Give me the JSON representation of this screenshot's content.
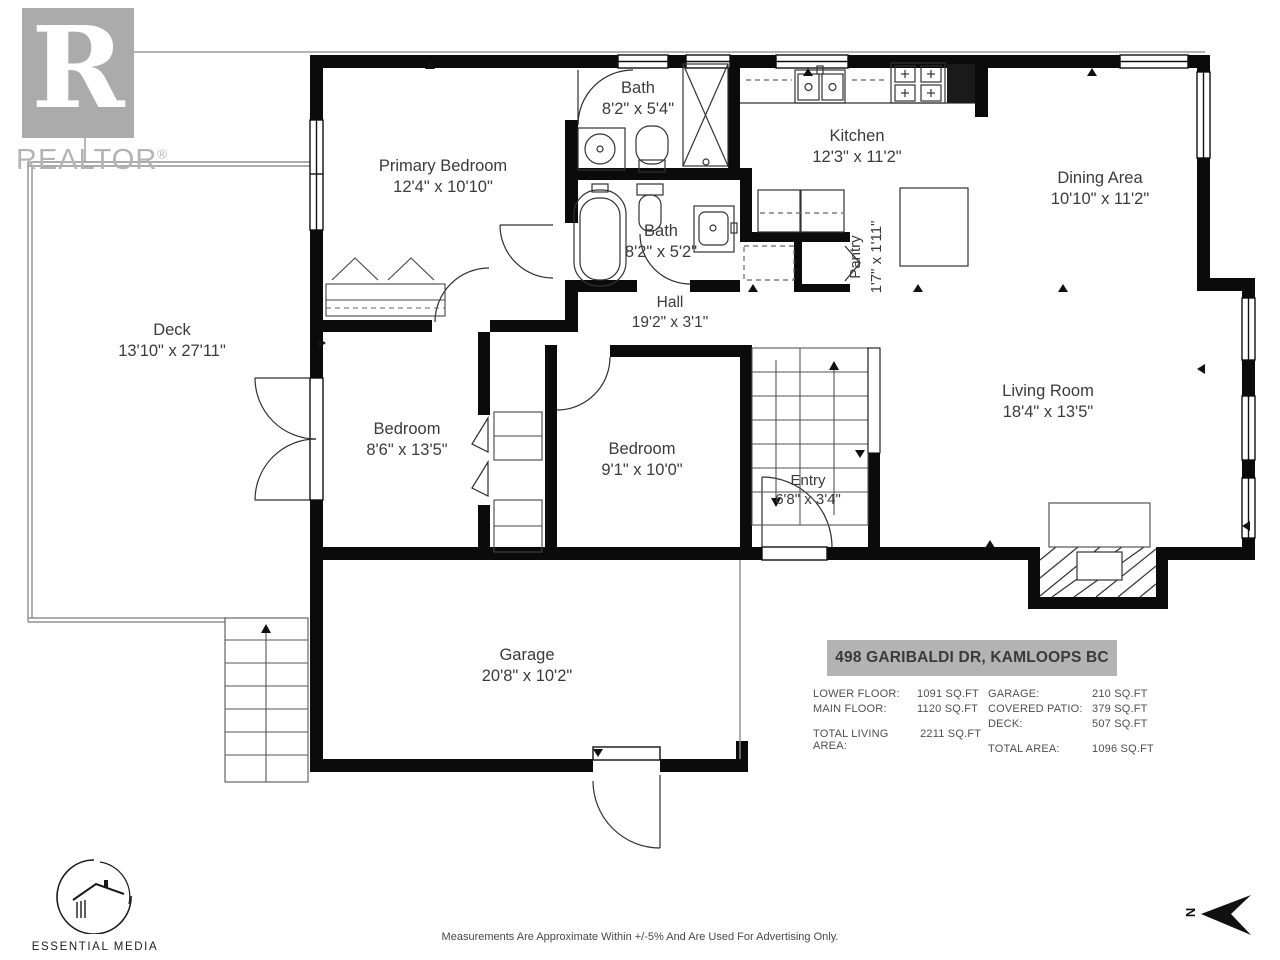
{
  "branding": {
    "realtor_logo_letter": "R",
    "realtor_word": "REALTOR",
    "registered_mark": "®",
    "vendor_name": "ESSENTIAL MEDIA"
  },
  "rooms": {
    "primary_bedroom": {
      "name": "Primary Bedroom",
      "dims": "12'4\" x 10'10\""
    },
    "bath_upper": {
      "name": "Bath",
      "dims": "8'2\" x 5'4\""
    },
    "bath_lower": {
      "name": "Bath",
      "dims": "8'2\" x 5'2\""
    },
    "kitchen": {
      "name": "Kitchen",
      "dims": "12'3\" x 11'2\""
    },
    "dining_area": {
      "name": "Dining Area",
      "dims": "10'10\" x 11'2\""
    },
    "pantry": {
      "name": "Pantry",
      "dims": "1'7\" x 1'11\""
    },
    "hall": {
      "name": "Hall",
      "dims": "19'2\" x 3'1\""
    },
    "deck": {
      "name": "Deck",
      "dims": "13'10\" x 27'11\""
    },
    "bedroom_west": {
      "name": "Bedroom",
      "dims": "8'6\" x 13'5\""
    },
    "bedroom_middle": {
      "name": "Bedroom",
      "dims": "9'1\" x 10'0\""
    },
    "entry": {
      "name": "Entry",
      "dims": "6'8\" x 3'4\""
    },
    "living_room": {
      "name": "Living Room",
      "dims": "18'4\" x 13'5\""
    },
    "garage": {
      "name": "Garage",
      "dims": "20'8\" x 10'2\""
    }
  },
  "summary": {
    "address": "498 GARIBALDI DR, KAMLOOPS BC",
    "left": [
      {
        "label": "LOWER FLOOR:",
        "value": "1091 SQ.FT"
      },
      {
        "label": "MAIN FLOOR:",
        "value": "1120 SQ.FT"
      },
      {
        "label": "TOTAL LIVING AREA:",
        "value": "2211 SQ.FT"
      }
    ],
    "right": [
      {
        "label": "GARAGE:",
        "value": "210 SQ.FT"
      },
      {
        "label": "COVERED PATIO:",
        "value": "379 SQ.FT"
      },
      {
        "label": "DECK:",
        "value": "507 SQ.FT"
      },
      {
        "label": "TOTAL AREA:",
        "value": "1096 SQ.FT"
      }
    ]
  },
  "footer": {
    "disclaimer": "Measurements Are Approximate Within +/-5% And Are Used For Advertising Only.",
    "north_label": "N"
  }
}
